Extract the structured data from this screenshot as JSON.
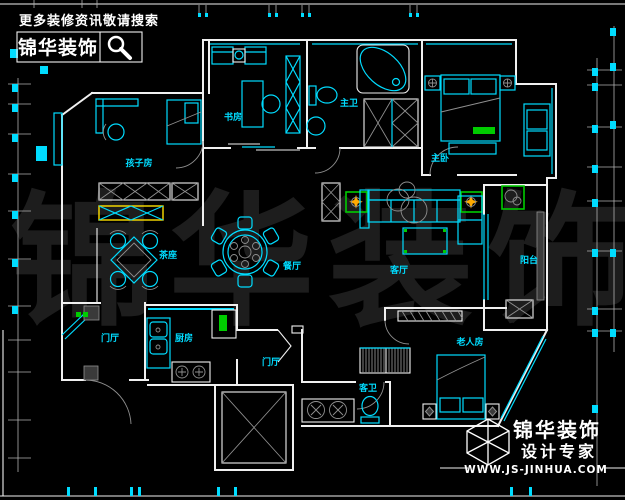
{
  "colors": {
    "bg": "#000000",
    "wall": "#f0f0f0",
    "white": "#ffffff",
    "cyan": "#00dcff",
    "label": "#00dcff",
    "gray": "#8f8f8f",
    "grayfill": "#3a3a3a",
    "green": "#00cc00",
    "yellow": "#ffe000",
    "orange": "#ffaa00",
    "dim": "#b0b0b0",
    "watermark": "#1d1d1d"
  },
  "header": {
    "tagline": "更多装修资讯敬请搜索",
    "brand": "锦华装饰",
    "search_icon": "magnifier-icon"
  },
  "watermark": {
    "text": "锦华装饰"
  },
  "rooms": [
    {
      "id": "kids-room",
      "label": "孩子房"
    },
    {
      "id": "study",
      "label": "书房"
    },
    {
      "id": "master-bathroom",
      "label": "主卫"
    },
    {
      "id": "master-bedroom",
      "label": "主卧"
    },
    {
      "id": "tea-area",
      "label": "茶座"
    },
    {
      "id": "dining-room",
      "label": "餐厅"
    },
    {
      "id": "living-room",
      "label": "客厅"
    },
    {
      "id": "balcony",
      "label": "阳台"
    },
    {
      "id": "entry-foyer",
      "label": "门厅"
    },
    {
      "id": "kitchen",
      "label": "厨房"
    },
    {
      "id": "hallway",
      "label": "门厅"
    },
    {
      "id": "guest-bathroom",
      "label": "客卫"
    },
    {
      "id": "elder-room",
      "label": "老人房"
    }
  ],
  "footer": {
    "brand": "锦华装饰",
    "tagline": "设计专家",
    "website": "WWW.JS-JINHUA.COM",
    "logo_icon": "cube-logo-icon"
  }
}
